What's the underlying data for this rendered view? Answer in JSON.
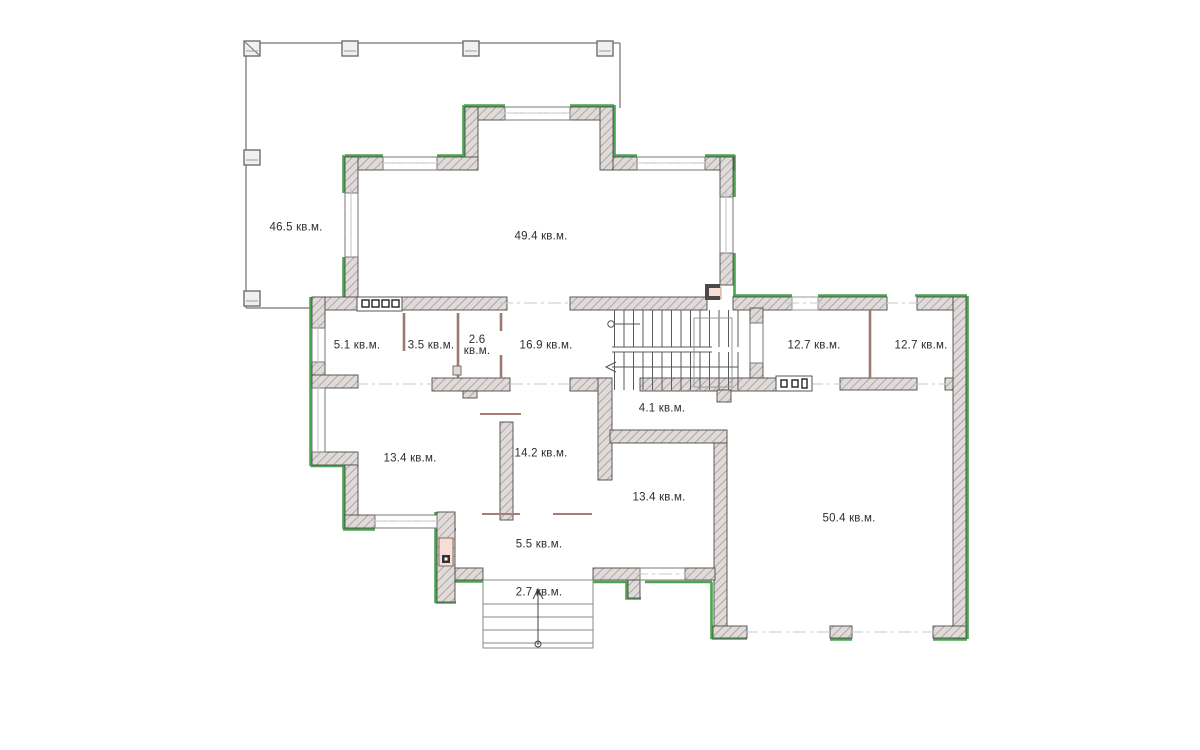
{
  "plan": {
    "unit_label": "кв.м.",
    "rooms": [
      {
        "id": "r1",
        "area": "46.5 кв.м."
      },
      {
        "id": "r2",
        "area": "49.4 кв.м."
      },
      {
        "id": "r3",
        "area": "5.1 кв.м."
      },
      {
        "id": "r4",
        "area": "3.5 кв.м."
      },
      {
        "id": "r5",
        "area": "2.6 кв.м."
      },
      {
        "id": "r6",
        "area": "16.9 кв.м."
      },
      {
        "id": "r7",
        "area": "12.7 кв.м."
      },
      {
        "id": "r8",
        "area": "12.7 кв.м."
      },
      {
        "id": "r9",
        "area": "4.1 кв.м."
      },
      {
        "id": "r10",
        "area": "13.4 кв.м."
      },
      {
        "id": "r11",
        "area": "14.2 кв.м."
      },
      {
        "id": "r12",
        "area": "13.4 кв.м."
      },
      {
        "id": "r13",
        "area": "50.4 кв.м."
      },
      {
        "id": "r14",
        "area": "5.5 кв.м."
      },
      {
        "id": "r15",
        "area": "2.7 кв.м."
      }
    ],
    "colors": {
      "wall_fill": "#e0dbd9",
      "wall_hatch": "#a09a98",
      "wall_outline": "#4a4a4a",
      "insulation_green": "#4ca450",
      "partition_brown": "#9b7a70",
      "accent_pink": "#f6ded6",
      "dash_gray": "#c8c8c8",
      "terrace_gray": "#8c8c8c"
    }
  }
}
